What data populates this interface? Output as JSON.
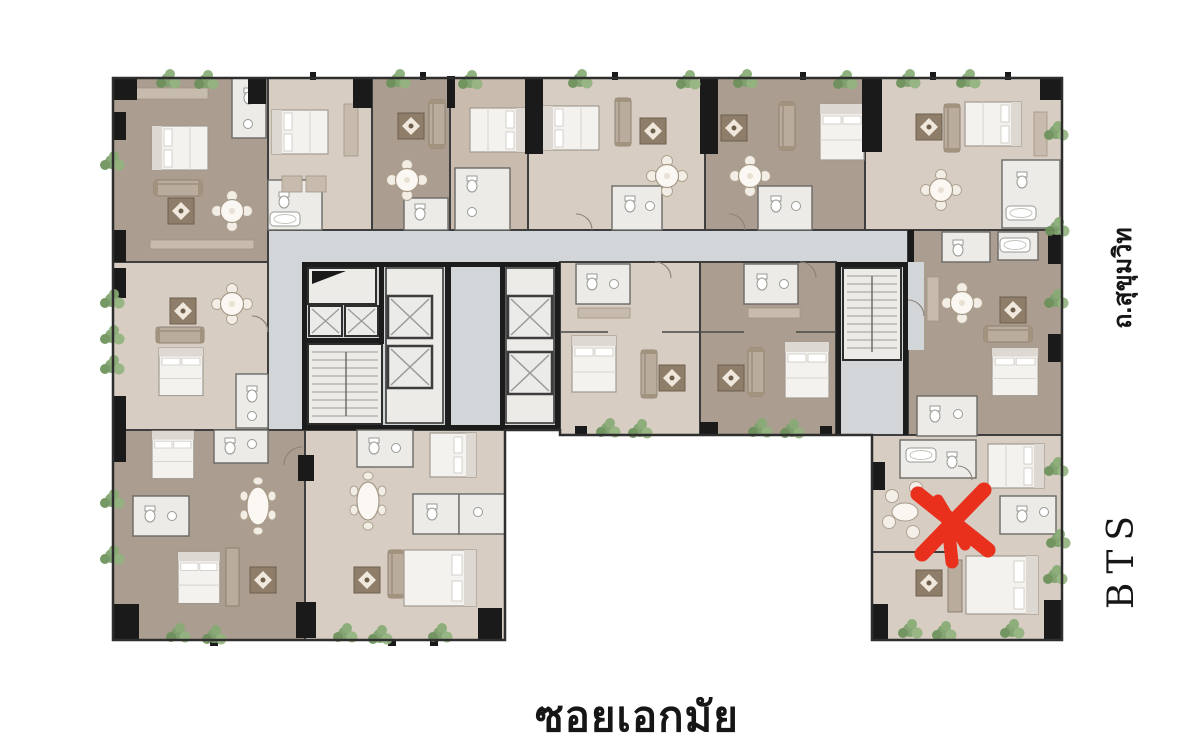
{
  "labels": {
    "soi_bottom": "ซอยเอกมัย",
    "road_right": "ถ.สุขุมวิท",
    "transit": "BTS"
  },
  "marker": {
    "icon": "red-x-marker",
    "color": "#e8301d",
    "location": "lower-right-unit"
  },
  "colors": {
    "background": "#ffffff",
    "corridor_gray": "#d3d6d8",
    "floor_light": "#d7cdc3",
    "floor_dark": "#ab9d8f",
    "floor_medium": "#c9bcae",
    "room_white": "#edebe8",
    "wall_dark": "#3e3e3e",
    "column_black": "#1a1a1a",
    "plant_green": "#7da26d",
    "label_text": "#161616"
  },
  "icons": {
    "marker": "red-x-marker",
    "plant": "plant-icon",
    "elevator": "elevator-icon",
    "stairs": "stairs-icon",
    "bed": "bed-icon",
    "sofa": "sofa-icon",
    "dining_table": "dining-table-icon",
    "coffee_table": "coffee-table-icon",
    "toilet": "toilet-icon",
    "bathtub": "bathtub-icon",
    "sink": "sink-icon"
  }
}
